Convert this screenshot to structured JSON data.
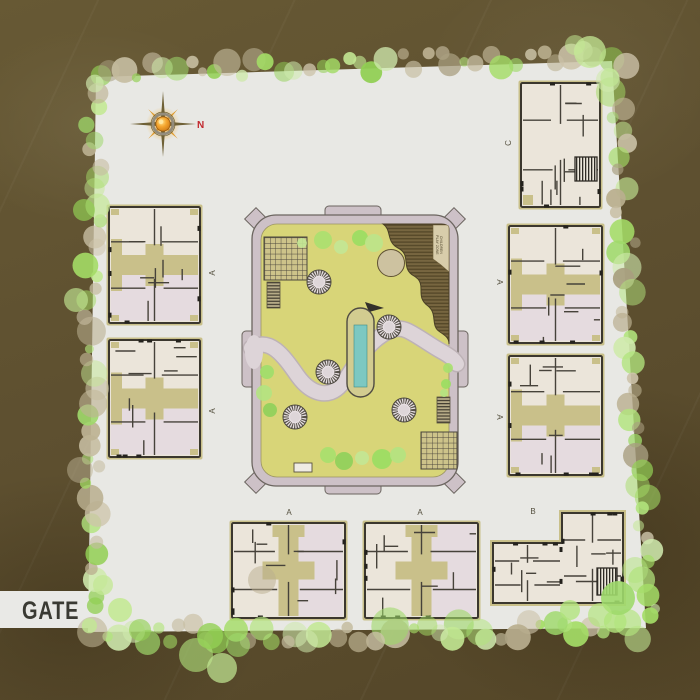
{
  "title": "Residential township site plan",
  "gate": {
    "label": "GATE"
  },
  "compass": {
    "north_label": "N"
  },
  "amenity": {
    "play_zone_lines": [
      "CHILDREN",
      "PLAY ZONE"
    ],
    "features": [
      "central lawn",
      "swimming pool",
      "walking path",
      "children play zone",
      "paved plazas",
      "planters"
    ]
  },
  "buildings": [
    {
      "id": "block-a-west-1",
      "label": "A",
      "type": "A-side",
      "x": 109,
      "y": 207,
      "w": 91,
      "h": 116,
      "lx": 215,
      "ly": 273,
      "lr": -90,
      "seed": 11
    },
    {
      "id": "block-a-west-2",
      "label": "A",
      "type": "A-side",
      "x": 109,
      "y": 340,
      "w": 91,
      "h": 117,
      "lx": 215,
      "ly": 411,
      "lr": -90,
      "seed": 22
    },
    {
      "id": "block-c-northeast",
      "label": "C",
      "type": "C",
      "x": 521,
      "y": 83,
      "w": 79,
      "h": 124,
      "lx": 511,
      "ly": 143,
      "lr": -90,
      "seed": 33
    },
    {
      "id": "block-a-east-1",
      "label": "A",
      "type": "A-side",
      "x": 509,
      "y": 226,
      "w": 93,
      "h": 117,
      "lx": 497,
      "ly": 282,
      "lr": 90,
      "seed": 44
    },
    {
      "id": "block-a-east-2",
      "label": "A",
      "type": "A-side",
      "x": 509,
      "y": 356,
      "w": 93,
      "h": 119,
      "lx": 497,
      "ly": 417,
      "lr": 90,
      "seed": 55
    },
    {
      "id": "block-a-south-1",
      "label": "A",
      "type": "A-bottom",
      "x": 232,
      "y": 523,
      "w": 113,
      "h": 95,
      "lx": 289,
      "ly": 515,
      "lr": 0,
      "seed": 66
    },
    {
      "id": "block-a-south-2",
      "label": "A",
      "type": "A-bottom",
      "x": 365,
      "y": 523,
      "w": 113,
      "h": 95,
      "lx": 420,
      "ly": 515,
      "lr": 0,
      "seed": 77
    },
    {
      "id": "block-b-southeast",
      "label": "B",
      "type": "B",
      "x": 493,
      "y": 513,
      "w": 130,
      "h": 90,
      "lx": 533,
      "ly": 514,
      "lr": 0,
      "seed": 88
    }
  ],
  "colors": {
    "background": "#5e5030",
    "site": "#e8e8e4",
    "lawn": "#d8d578",
    "garden_ring": "#cdc1c7",
    "walkway": "#ddd4d8",
    "pool_water": "#7cc8c2",
    "play_zone": "#776640",
    "building_wall": "#3b372e",
    "building_floor": "#ebe5da",
    "building_floor_pink": "#e5dbdf",
    "building_core": "#c9c08a",
    "tree_green": "#a4dc66",
    "north_red": "#c1272d"
  }
}
